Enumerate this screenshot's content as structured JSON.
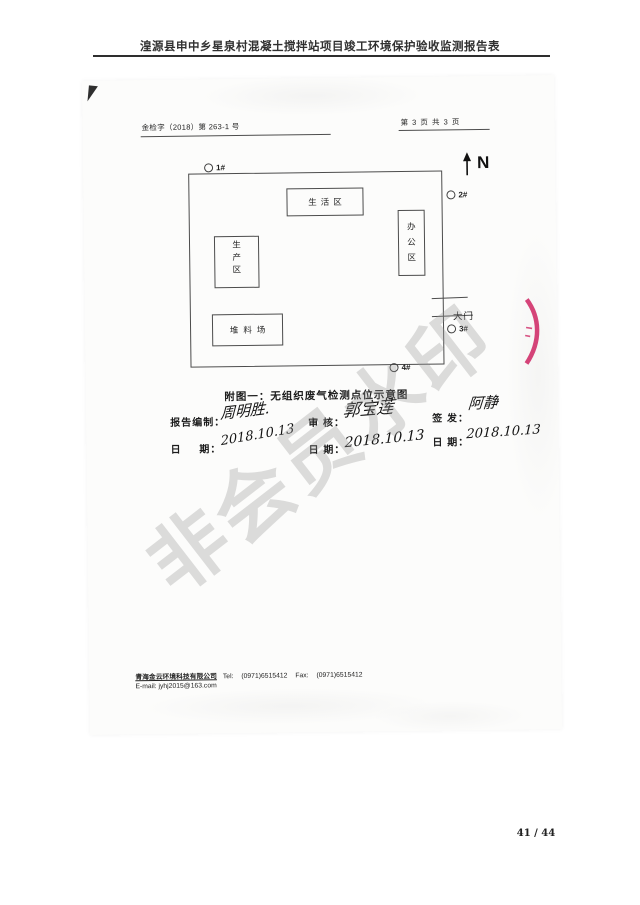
{
  "header": {
    "title": "湟源县申中乡星泉村混凝土搅拌站项目竣工环境保护验收监测报告表",
    "page_number": "41 / 44"
  },
  "scan": {
    "ref_no": "金检字（2018）第 263-1 号",
    "page_info": "第 3 页 共 3 页",
    "watermark": "非会员水印"
  },
  "diagram": {
    "north_label": "N",
    "caption": "附图一：无组织废气检测点位示意图",
    "areas": {
      "living": "生活区",
      "office": "办公区",
      "production": "生产区",
      "stockyard": "堆料场"
    },
    "gate_label": "大门",
    "points": [
      {
        "label": "1#"
      },
      {
        "label": "2#"
      },
      {
        "label": "3#"
      },
      {
        "label": "4#"
      }
    ]
  },
  "signatures": {
    "prepared": {
      "label": "报告编制：",
      "name": "周明胜.",
      "date_label": "日 期：",
      "date": "2018.10.13"
    },
    "reviewed": {
      "label": "审 核：",
      "name": "郭宝莲",
      "date_label": "日 期：",
      "date": "2018.10.13"
    },
    "issued": {
      "label": "签 发：",
      "name": "阿静",
      "date_label": "日 期：",
      "date": "2018.10.13"
    }
  },
  "footer": {
    "company": "青海金云环境科技有限公司",
    "tel_label": "Tel:",
    "tel": "(0971)6515412",
    "fax_label": "Fax:",
    "fax": "(0971)6515412",
    "email": "E-mail: jyhj2015@163.com"
  }
}
